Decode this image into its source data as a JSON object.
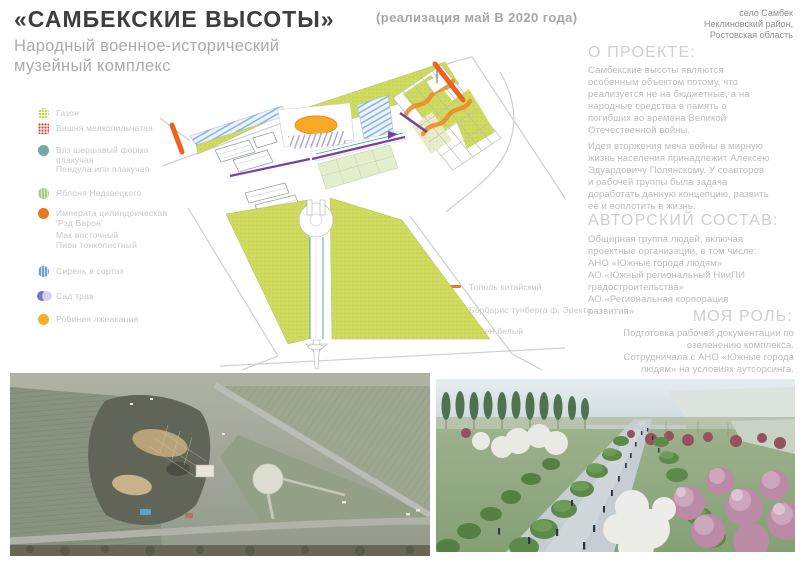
{
  "header": {
    "title": "«САМБЕКСКИЕ ВЫСОТЫ»",
    "subtitle": "Народный военное-исторический\nмузейный комплекс",
    "realization": "(реализация май В 2020 года)",
    "location": "село Самбек\nНеклиновский район,\nРостовская область"
  },
  "about": {
    "heading": "О ПРОЕКТЕ:",
    "paragraphs": [
      "Самбекские высоты являются\nособенным объектом потому, что\nреализуется не на бюджетные, а на\nнародные средства в память о\nпогибших во времена Великой\nОтечественной войны.",
      "Идея вторжения меча войны в мирную\nжизнь населения принадлежит Алексею\nЭдуардовичу Полянскому.  У соавторов\nи рабочей группы была задача\nдоработать данную концепцию, развить\nеё и воплотить в жизнь."
    ]
  },
  "authors": {
    "heading": "АВТОРСКИЙ СОСТАВ:",
    "body": "Общирная группа людей, включая\nпроектные организации, в том числе:\nАНО «Южные города людям»\nАО «Южный региональный НииПИ\nградостроительства»\nАО «Региональная корпорация\nразвития»"
  },
  "role": {
    "heading": "МОЯ РОЛЬ:",
    "body": "Подготовка рабочей документации по\nозеленению комплекса.\nСотрудничала с АНО «Южные города\nлюдям» на условиях аутсорсинга."
  },
  "plant_legend": {
    "items": [
      {
        "icon": "lawn-swatch",
        "color": "#c6d64e",
        "label": "Газон"
      },
      {
        "icon": "cherry-swatch",
        "color": "#c24848",
        "label": "Вишня мелкопильчатая"
      },
      {
        "icon": "elm-swatch",
        "color": "#72a9ab",
        "label": "Вяз шершавый форма\nплакучая\nПендула или плакучая"
      },
      {
        "icon": "apple-swatch",
        "color": "#a6ce85",
        "label": "Яблоня Недзвецкого"
      },
      {
        "icon": "imperata-swatch",
        "color": "#e8791e",
        "label": "Императа цилиндрическая\n'Рэд Барон'"
      },
      {
        "icon": "none",
        "color": "",
        "label": "Мак восточный\nПион тонколистный"
      },
      {
        "icon": "lilac-swatch",
        "color": "#6fa3d8",
        "label": "Сирень в сортах"
      },
      {
        "icon": "herbs-swatch",
        "color": "#7377c2",
        "label": "Сад трав"
      },
      {
        "icon": "robinia-swatch",
        "color": "#f2ae2c",
        "label": "Робиния лжеакация"
      }
    ]
  },
  "plan_legend": {
    "items": [
      {
        "swatch_color": "#e07b2a",
        "label": "Тополь китайский"
      },
      {
        "swatch_color": "#7b4fa0",
        "label": "Барбарис тунберга ф. Эректа"
      },
      {
        "swatch_color": "",
        "label": "Дерен белый"
      }
    ]
  },
  "colors": {
    "accent_orange": "#e8721f",
    "accent_purple": "#7b3fa0",
    "plan_green": "#cedb5e",
    "text_gray": "#bdbdbd"
  }
}
